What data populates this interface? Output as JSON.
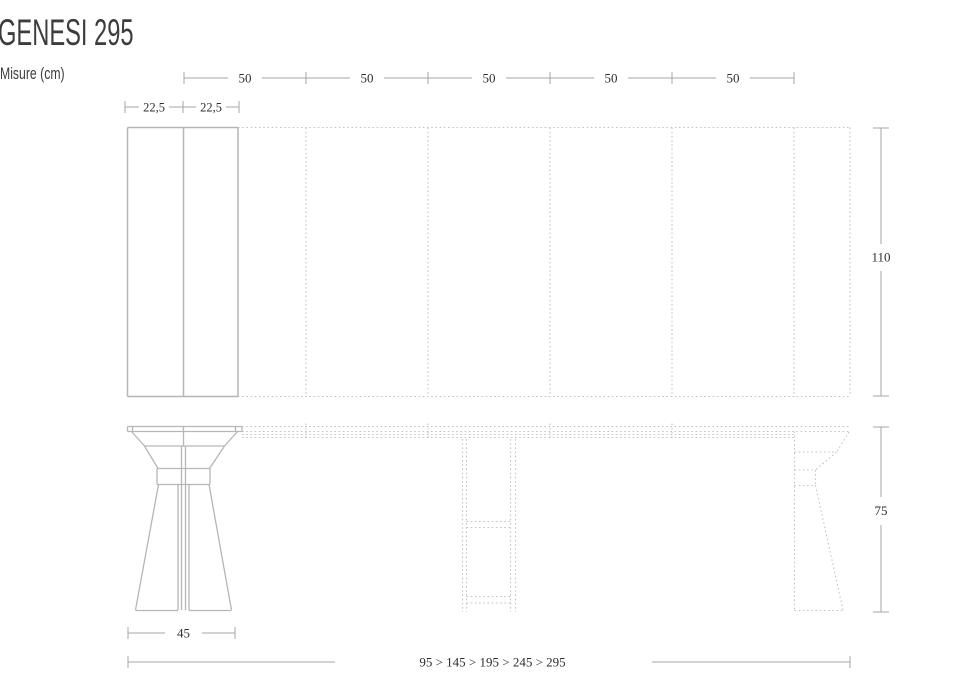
{
  "title": "GENESI 295",
  "subtitle": "Misure (cm)",
  "plan": {
    "segment_labels": [
      "50",
      "50",
      "50",
      "50",
      "50"
    ],
    "leaf_labels": [
      "22,5",
      "22,5"
    ],
    "depth_label": "110"
  },
  "elevation": {
    "height_label": "75",
    "base_width_label": "45",
    "extension_sequence_label": "95 > 145 > 195 > 245 > 295"
  },
  "colors": {
    "background": "#ffffff",
    "solid_line": "#b6b6b6",
    "dashed_line": "#c4c4c4",
    "dimension_line": "#a6a6a6",
    "dimension_text": "#2e2e2e",
    "title_text": "#3d3d3d"
  }
}
